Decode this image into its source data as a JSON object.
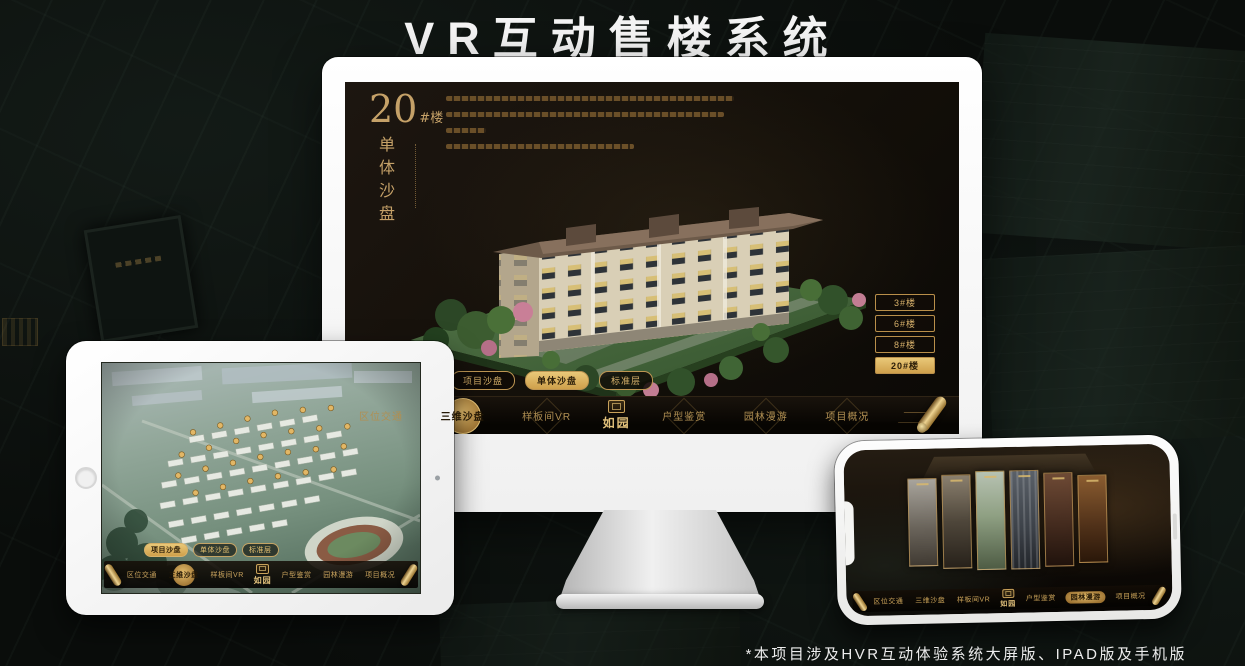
{
  "page": {
    "title": "VR互动售楼系统",
    "footnote": "*本项目涉及HVR互动体验系统大屏版、IPAD版及手机版"
  },
  "colors": {
    "gold": "#cda85e",
    "gold_bright": "#e7c476",
    "screen_dark": "#14100a",
    "background": "#0a0d0b"
  },
  "desktop": {
    "detail_title": {
      "number": "20",
      "suffix": "#楼",
      "subtitle": "单体沙盘"
    },
    "floor_buttons": [
      {
        "label": "3#楼",
        "active": false
      },
      {
        "label": "6#楼",
        "active": false
      },
      {
        "label": "8#楼",
        "active": false
      },
      {
        "label": "20#楼",
        "active": true
      }
    ],
    "sub_tabs": [
      {
        "label": "项目沙盘",
        "active": false
      },
      {
        "label": "单体沙盘",
        "active": true
      },
      {
        "label": "标准层",
        "active": false
      }
    ],
    "menu": {
      "logo": "如园",
      "items": [
        {
          "label": "区位交通",
          "active": false
        },
        {
          "label": "三维沙盘",
          "active": true
        },
        {
          "label": "样板间VR",
          "active": false
        },
        {
          "label": "户型鉴赏",
          "active": false
        },
        {
          "label": "园林漫游",
          "active": false
        },
        {
          "label": "项目概况",
          "active": false
        }
      ]
    }
  },
  "tablet": {
    "sub_tabs": [
      {
        "label": "项目沙盘",
        "active": true
      },
      {
        "label": "单体沙盘",
        "active": false
      },
      {
        "label": "标准层",
        "active": false
      }
    ],
    "menu": {
      "logo": "如园",
      "items": [
        {
          "label": "区位交通",
          "active": false
        },
        {
          "label": "三维沙盘",
          "active": true
        },
        {
          "label": "样板间VR",
          "active": false
        },
        {
          "label": "户型鉴赏",
          "active": false
        },
        {
          "label": "园林漫游",
          "active": false
        },
        {
          "label": "项目概况",
          "active": false
        }
      ]
    }
  },
  "phone": {
    "gallery_panel_count": 6,
    "menu": {
      "logo": "如园",
      "items": [
        {
          "label": "区位交通",
          "active": false
        },
        {
          "label": "三维沙盘",
          "active": false
        },
        {
          "label": "样板间VR",
          "active": false
        },
        {
          "label": "户型鉴赏",
          "active": false
        },
        {
          "label": "园林漫游",
          "active": true
        },
        {
          "label": "项目概况",
          "active": false
        }
      ]
    }
  },
  "icons": {
    "scroll": "scroll-icon",
    "home_button": "home-button",
    "camera": "camera-dot"
  }
}
